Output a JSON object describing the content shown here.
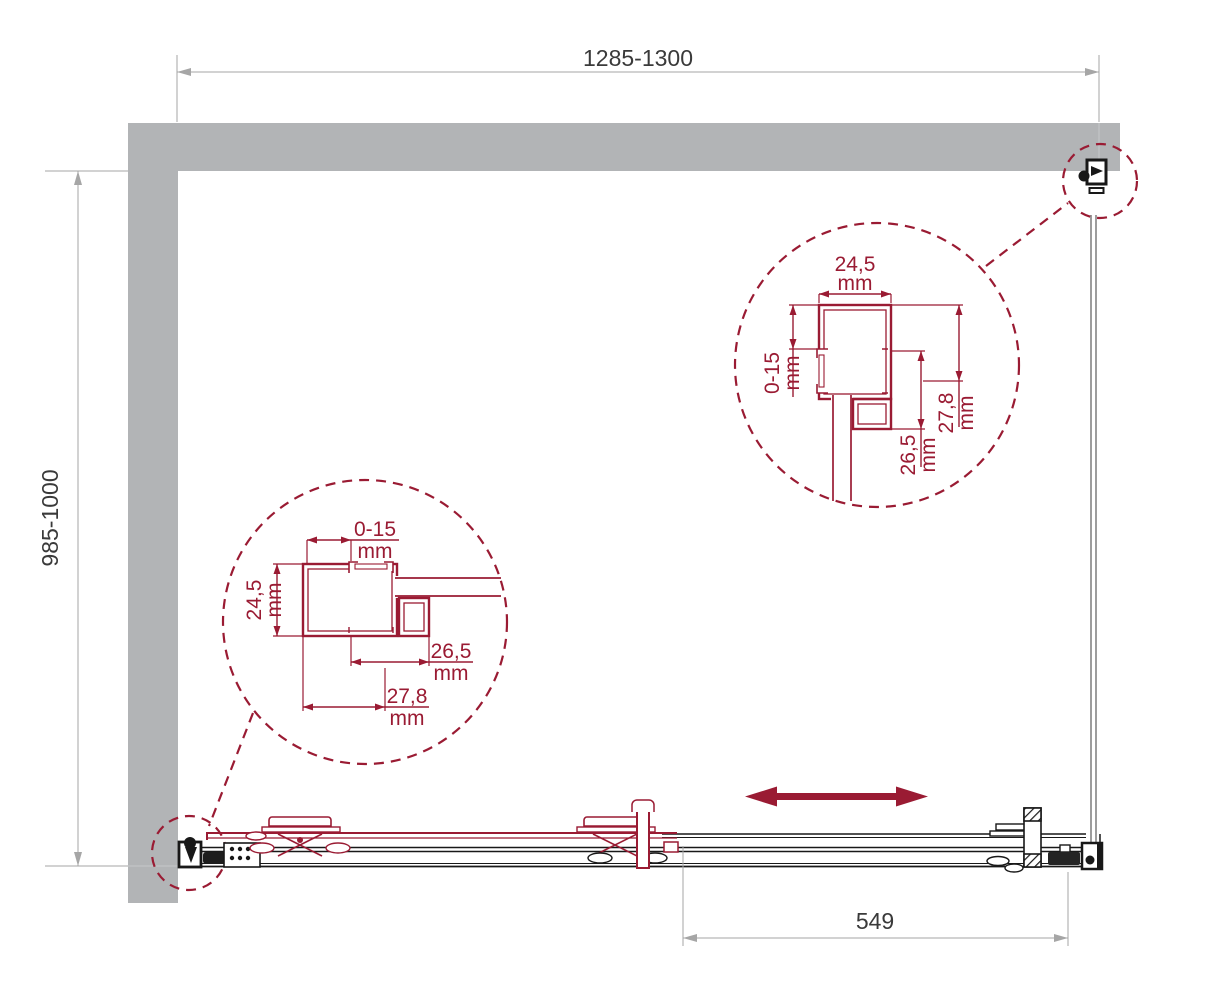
{
  "drawing": {
    "kind": "shower-enclosure-installation-plan",
    "dimensions": {
      "top": {
        "label": "1285-1300"
      },
      "left": {
        "label": "985-1000"
      },
      "bottom": {
        "label": "549"
      }
    },
    "detail_right": {
      "top": {
        "value": "24,5",
        "unit": "mm"
      },
      "left": {
        "value": "0-15",
        "unit": "mm"
      },
      "right": {
        "value": "27,8",
        "unit": "mm"
      },
      "inner": {
        "value": "26,5",
        "unit": "mm"
      }
    },
    "detail_left": {
      "top": {
        "value": "0-15",
        "unit": "mm"
      },
      "left": {
        "value": "24,5",
        "unit": "mm"
      },
      "right": {
        "value": "26,5",
        "unit": "mm"
      },
      "bottom": {
        "value": "27,8",
        "unit": "mm"
      }
    },
    "icons": {
      "slide_direction": "double-headed-arrow"
    },
    "colors": {
      "accent": "#9a1b33",
      "wall": "#b2b4b6",
      "dim_line": "#a6a6a6",
      "dim_text": "#3a3a3a",
      "hardware": "#181818",
      "glass": "#7d7d7d"
    }
  }
}
